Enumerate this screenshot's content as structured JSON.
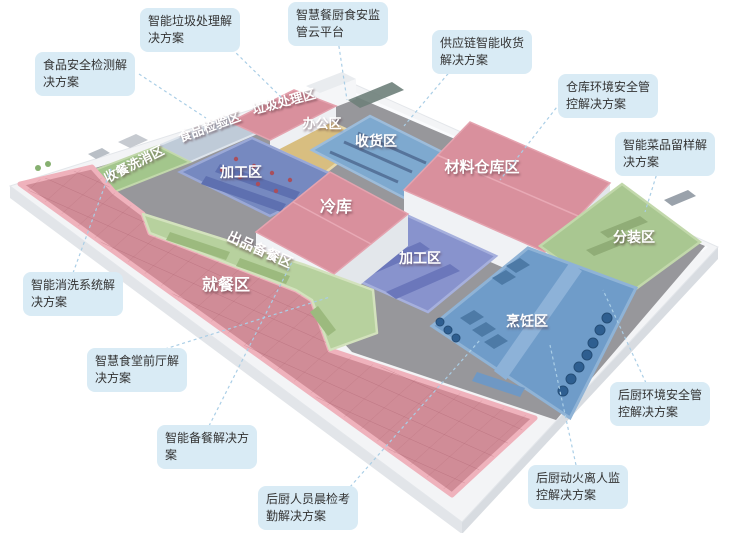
{
  "map": {
    "zones": [
      {
        "id": "dish-return-wash",
        "label": "收餐洗消区"
      },
      {
        "id": "food-inspection",
        "label": "食品检验区"
      },
      {
        "id": "waste-treatment",
        "label": "垃圾处理区"
      },
      {
        "id": "office",
        "label": "办公区"
      },
      {
        "id": "receiving",
        "label": "收货区"
      },
      {
        "id": "material-warehouse",
        "label": "材料仓库区"
      },
      {
        "id": "portioning",
        "label": "分装区"
      },
      {
        "id": "processing-north",
        "label": "加工区"
      },
      {
        "id": "cold-storage",
        "label": "冷库"
      },
      {
        "id": "processing-center",
        "label": "加工区"
      },
      {
        "id": "serving-prep",
        "label": "出品备餐区"
      },
      {
        "id": "dining",
        "label": "就餐区"
      },
      {
        "id": "cooking",
        "label": "烹饪区"
      }
    ]
  },
  "callouts": [
    {
      "id": "smart-waste",
      "label": "智能垃圾处理解决方案"
    },
    {
      "id": "cloud-platform",
      "label": "智慧餐厨食安监管云平台"
    },
    {
      "id": "food-safety-test",
      "label": "食品安全检测解决方案"
    },
    {
      "id": "supply-chain",
      "label": "供应链智能收货解决方案"
    },
    {
      "id": "warehouse-env",
      "label": "仓库环境安全管控解决方案"
    },
    {
      "id": "dish-sampling",
      "label": "智能菜品留样解决方案"
    },
    {
      "id": "smart-washing",
      "label": "智能消洗系统解决方案"
    },
    {
      "id": "front-hall",
      "label": "智慧食堂前厅解决方案"
    },
    {
      "id": "smart-prep",
      "label": "智能备餐解决方案"
    },
    {
      "id": "staff-check",
      "label": "后厨人员晨检考勤解决方案"
    },
    {
      "id": "kitchen-env",
      "label": "后厨环境安全管控解决方案"
    },
    {
      "id": "fire-monitor",
      "label": "后厨动火离人监控解决方案"
    }
  ],
  "colors": {
    "plate": "#f3f4f6",
    "corridor": "#97979b",
    "dining_pink": "#d08c97",
    "roof_pink": "#d9909d",
    "serve_green": "#b7d19e",
    "wash_green": "#a3c68c",
    "pack_green": "#a9c791",
    "cook_blue": "#6f9cc9",
    "receive_blue": "#7ea9cf",
    "process_indigo": "#7689c0",
    "process_purple": "#8893cd",
    "office_yellow": "#d8be80",
    "inspect_gray": "#bfcbd8",
    "callout_bg": "#d9ebf5",
    "callout_text": "#333333",
    "leader_line": "#aacee6"
  }
}
